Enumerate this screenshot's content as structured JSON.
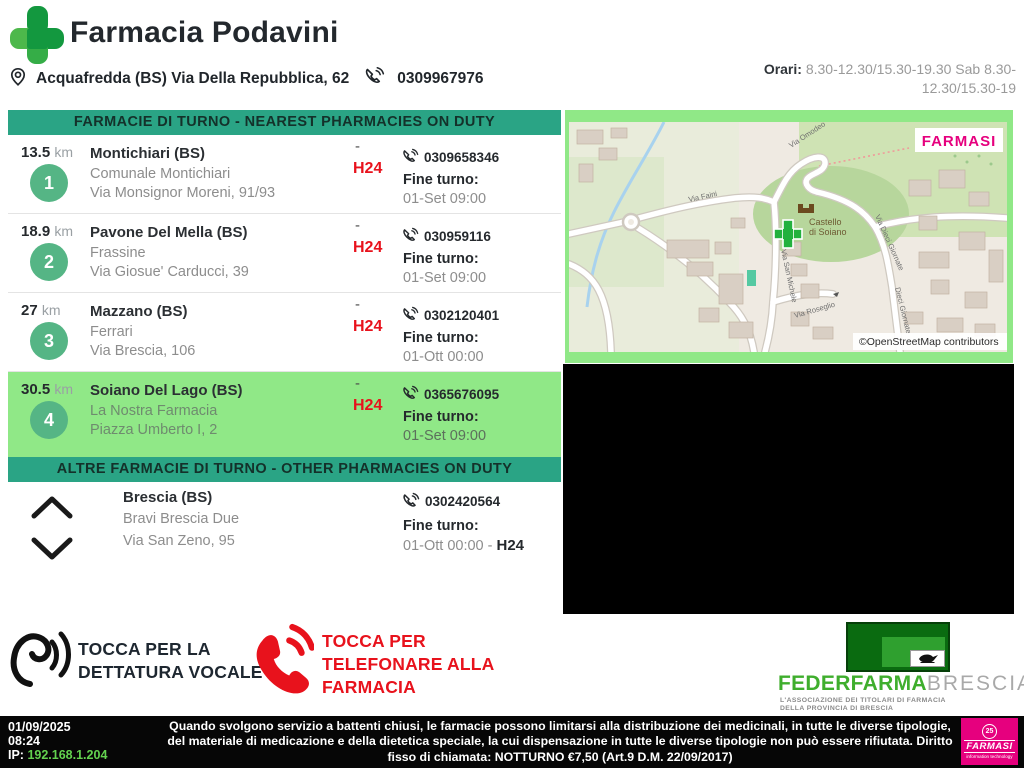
{
  "header": {
    "title": "Farmacia Podavini",
    "address": "Acquafredda (BS) Via Della Repubblica, 62",
    "phone": "0309967976",
    "hours_label": "Orari:",
    "hours": "8.30-12.30/15.30-19.30 Sab 8.30-12.30/15.30-19"
  },
  "nearest": {
    "banner": "FARMACIE DI TURNO - NEAREST PHARMACIES ON DUTY",
    "items": [
      {
        "distance": "13.5",
        "unit": "km",
        "number": "1",
        "city": "Montichiari (BS)",
        "name": "Comunale Montichiari",
        "street": "Via Monsignor Moreni, 91/93",
        "dash": "-",
        "h24": "H24",
        "phone": "0309658346",
        "fine_label": "Fine turno:",
        "fine": "01-Set 09:00"
      },
      {
        "distance": "18.9",
        "unit": "km",
        "number": "2",
        "city": "Pavone Del Mella (BS)",
        "name": "Frassine",
        "street": "Via Giosue' Carducci, 39",
        "dash": "-",
        "h24": "H24",
        "phone": "030959116",
        "fine_label": "Fine turno:",
        "fine": "01-Set 09:00"
      },
      {
        "distance": "27",
        "unit": "km",
        "number": "3",
        "city": "Mazzano (BS)",
        "name": "Ferrari",
        "street": "Via Brescia, 106",
        "dash": "-",
        "h24": "H24",
        "phone": "0302120401",
        "fine_label": "Fine turno:",
        "fine": "01-Ott 00:00"
      },
      {
        "distance": "30.5",
        "unit": "km",
        "number": "4",
        "city": "Soiano Del Lago (BS)",
        "name": "La Nostra Farmacia",
        "street": "Piazza Umberto I, 2",
        "dash": "-",
        "h24": "H24",
        "phone": "0365676095",
        "fine_label": "Fine turno:",
        "fine": "01-Set 09:00"
      }
    ]
  },
  "other": {
    "banner": "ALTRE FARMACIE DI TURNO - OTHER PHARMACIES ON DUTY",
    "item": {
      "city": "Brescia (BS)",
      "name": "Bravi Brescia Due",
      "street": "Via San Zeno, 95",
      "phone": "0302420564",
      "fine_label": "Fine turno:",
      "fine": "01-Ott 00:00 - ",
      "fine_h24": "H24"
    }
  },
  "map": {
    "brand": "FARMASI",
    "attribution": "©OpenStreetMap contributors",
    "poi_line1": "Castello",
    "poi_line2": "di Soiano",
    "streets": [
      "Via Omodeo",
      "Via Faini",
      "Via San Michele",
      "Via Roseglio",
      "Via Dieci Giornate",
      "Dieci Giornate"
    ]
  },
  "actions": {
    "voice_line1": "TOCCA PER LA",
    "voice_line2": "DETTATURA VOCALE",
    "call_line1": "TOCCA PER",
    "call_line2": "TELEFONARE ALLA",
    "call_line3": "FARMACIA"
  },
  "federfarma": {
    "brand": "FEDERFARMA",
    "brand2": "BRESCIA",
    "tagline1": "L'ASSOCIAZIONE DEI TITOLARI DI FARMACIA",
    "tagline2": "DELLA PROVINCIA DI BRESCIA"
  },
  "footer": {
    "date": "01/09/2025",
    "time": "08:24",
    "ip_label": "IP: ",
    "ip": "192.168.1.204",
    "disclaimer": "Quando svolgono servizio a battenti chiusi, le farmacie possono limitarsi alla distribuzione dei medicinali, in tutte le diverse tipologie, del materiale di medicazione e della dietetica speciale, la cui dispensazione in tutte le diverse tipologie non può essere rifiutata. Diritto fisso di chiamata: NOTTURNO €7,50 (Art.9 D.M. 22/09/2017)",
    "farmasi_badge": "25",
    "farmasi_brand": "FARMASI",
    "farmasi_tagline": "information technology"
  },
  "colors": {
    "banner_teal": "#2aa485",
    "highlight_green": "#90e887",
    "badge_green": "#55b585",
    "alert_red": "#e8121c",
    "federfarma_green": "#3fae2d",
    "farmasi_pink": "#e6007e",
    "ip_green": "#63d34f"
  }
}
